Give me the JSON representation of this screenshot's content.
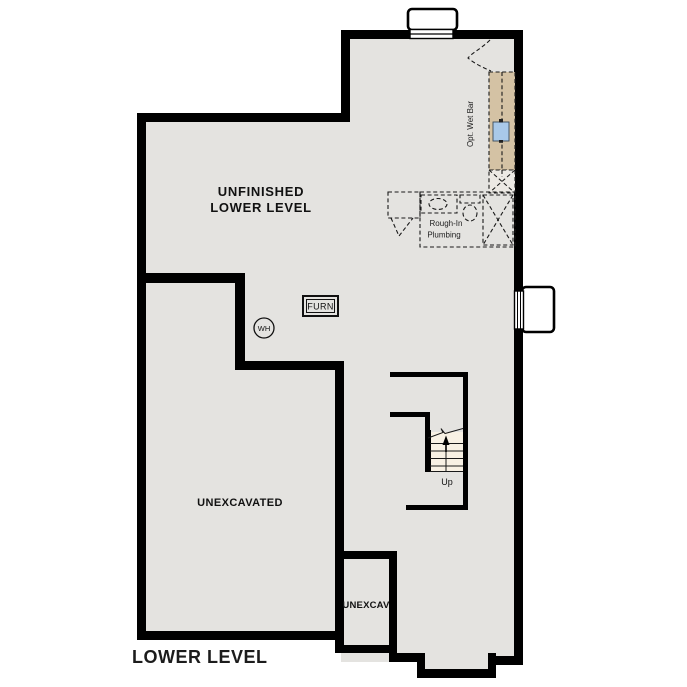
{
  "plan": {
    "title": "LOWER LEVEL",
    "rooms": {
      "unfinished": {
        "line1": "UNFINISHED",
        "line2": "LOWER LEVEL"
      },
      "unexcavated_main": {
        "label": "UNEXCAVATED"
      },
      "unexcavated_small": {
        "label": "UNEXCAV"
      }
    },
    "fixtures": {
      "furnace": {
        "label": "FURN"
      },
      "water_heater": {
        "label": "WH"
      },
      "wet_bar": {
        "label": "Opt. Wet Bar"
      },
      "rough_in": {
        "line1": "Rough-In",
        "line2": "Plumbing"
      },
      "stairs": {
        "label": "Up"
      }
    },
    "colors": {
      "floor": "#e4e3e0",
      "wall": "#000000",
      "counter": "#d4c2a4",
      "sink": "#a9c9e9",
      "stairs": "#f8f1e4",
      "optional_box": "#ece9e4",
      "background": "#ffffff"
    }
  }
}
